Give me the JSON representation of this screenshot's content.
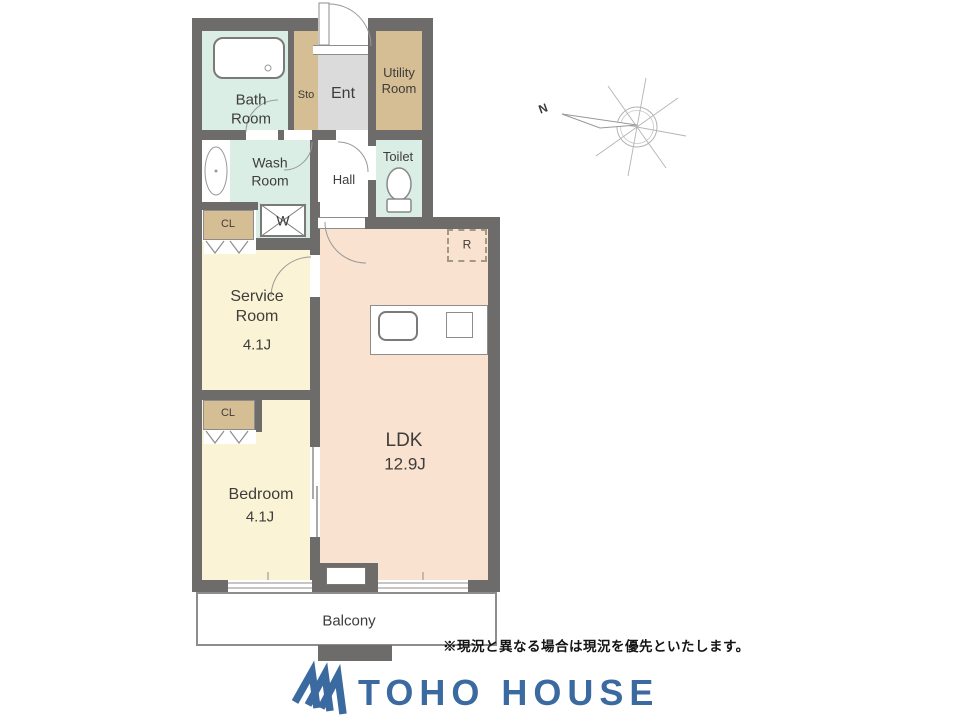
{
  "colors": {
    "wall": "#6e6c6a",
    "wet_room_mint": "#dbeee6",
    "storage_tan": "#d5bd94",
    "entry_gray": "#dbdbdb",
    "room_cream": "#faf3d6",
    "ldk_peach": "#f9e2cf",
    "line_gray": "#8f8d8b",
    "logo_blue": "#3b6aa0",
    "label_text": "#3f3d3b"
  },
  "plan": {
    "rooms": {
      "bath": {
        "label": "Bath Room"
      },
      "storage": {
        "label": "Sto"
      },
      "entrance": {
        "label": "Ent"
      },
      "utility": {
        "label": "Utility Room"
      },
      "wash": {
        "label": "Wash Room"
      },
      "hall": {
        "label": "Hall"
      },
      "toilet": {
        "label": "Toilet"
      },
      "closet_upper": {
        "label": "CL"
      },
      "washer": {
        "label": "W"
      },
      "service": {
        "label": "Service Room",
        "size": "4.1J"
      },
      "refrigerator": {
        "label": "R"
      },
      "ldk": {
        "label": "LDK",
        "size": "12.9J"
      },
      "closet_lower": {
        "label": "CL"
      },
      "bedroom": {
        "label": "Bedroom",
        "size": "4.1J"
      },
      "balcony": {
        "label": "Balcony"
      }
    },
    "compass": {
      "north": "N"
    }
  },
  "footer": {
    "disclaimer": "※現況と異なる場合は現況を優先といたします。",
    "brand": "TOHO HOUSE"
  }
}
